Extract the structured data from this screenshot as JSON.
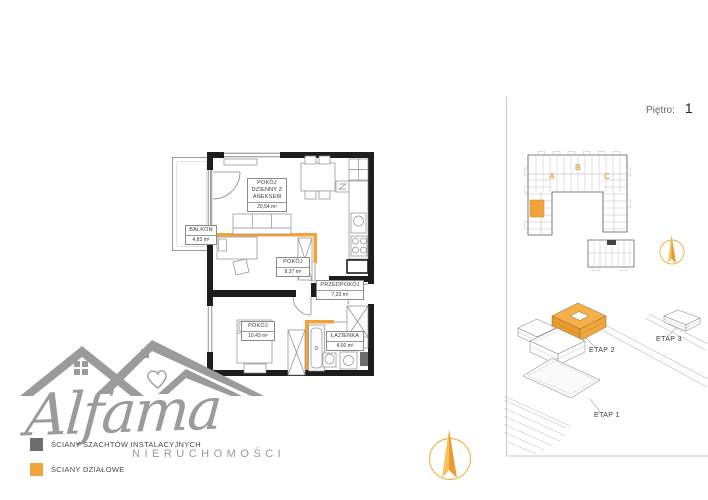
{
  "header": {
    "floor_label": "Piętro:",
    "floor_value": "1"
  },
  "apartment": {
    "rooms": {
      "living": {
        "name": "POKÓJ DZIENNY Z ANEKSEM",
        "area": "20,54 m²"
      },
      "balcony": {
        "name": "BALKON",
        "area": "4,83 m²"
      },
      "bedroom1": {
        "name": "POKÓJ",
        "area": "8,37 m²"
      },
      "hall": {
        "name": "PRZEDPOKÓJ",
        "area": "7,23 m²"
      },
      "bedroom2": {
        "name": "POKÓJ",
        "area": "10,43 m²"
      },
      "bathroom": {
        "name": "ŁAZIENKA",
        "area": "4,00 m²"
      }
    }
  },
  "legend": {
    "shaft_label": "ŚCIANY SZACHTÓW INSTALACYJNYCH",
    "partition_label": "ŚCIANY DZIAŁOWE",
    "shaft_color": "#6d6e71",
    "partition_color": "#f2a33c"
  },
  "logo": {
    "brand": "Alfama",
    "subtitle": "NIERUCHOMOŚCI"
  },
  "site": {
    "sections": {
      "a": "A",
      "b": "B",
      "c": "C"
    },
    "stage1": "ETAP 1",
    "stage2": "ETAP 2",
    "stage3": "ETAP 3"
  },
  "colors": {
    "wall_black": "#1d1d1b",
    "partition_orange": "#f2a33c",
    "shaft_gray": "#6d6e71",
    "logo_gray": "#9b9b9b",
    "compass_orange": "#eda12d"
  }
}
